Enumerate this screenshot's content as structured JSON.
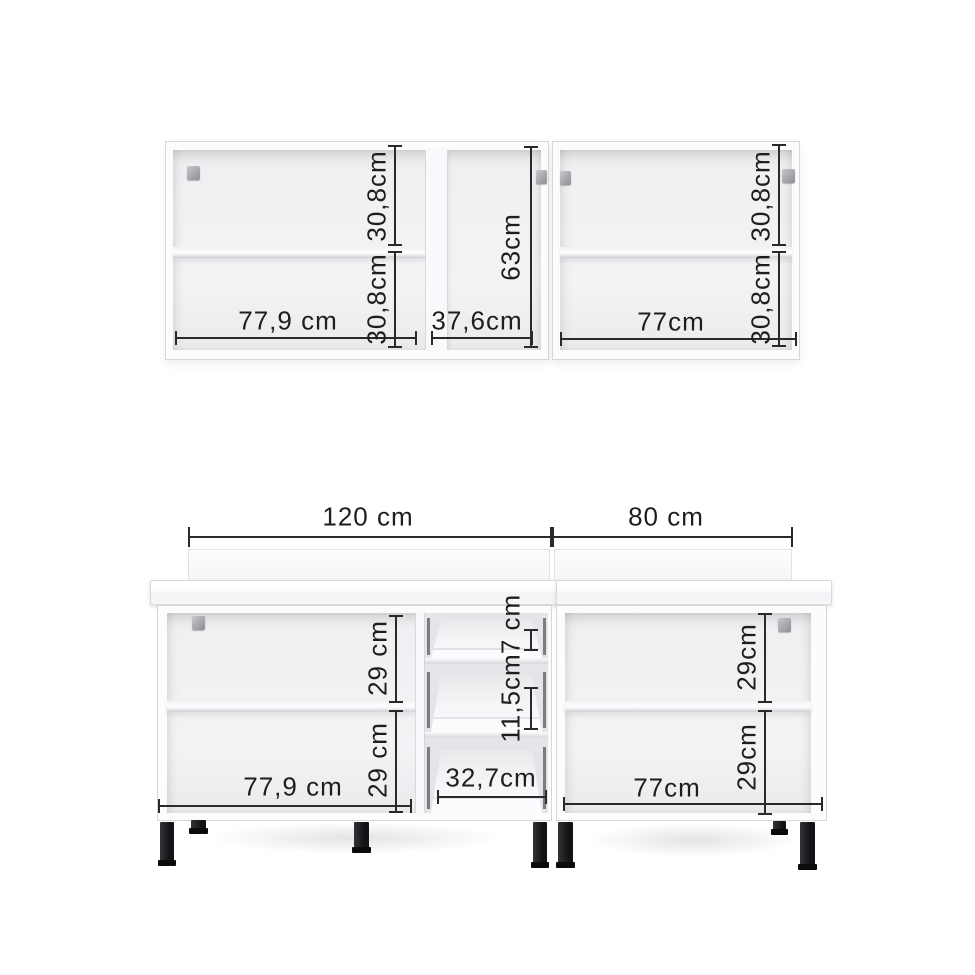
{
  "diagram_title": "kitchen-cabinet-dimensions",
  "upper_cabinet": {
    "left": {
      "width": "77,9 cm",
      "top_height": "30,8cm",
      "bottom_height": "30,8cm"
    },
    "middle": {
      "width": "37,6cm",
      "height": "63cm"
    },
    "right": {
      "width": "77cm",
      "top_height": "30,8cm",
      "bottom_height": "30,8cm"
    }
  },
  "base_cabinet": {
    "left_unit_width": "120 cm",
    "right_unit_width": "80 cm",
    "left": {
      "width": "77,9 cm",
      "top_height": "29 cm",
      "bottom_height": "29 cm"
    },
    "drawer_unit": {
      "width": "32,7cm",
      "top_drawer_height": "7 cm",
      "middle_drawer_height": "11,5cm"
    },
    "right": {
      "width": "77cm",
      "top_height": "29cm",
      "bottom_height": "29cm"
    }
  },
  "colors": {
    "dimension_line": "#2a2a2a",
    "cabinet_white": "#fcfcfd",
    "interior_gray": "#eff0f2",
    "leg_black": "#131315"
  }
}
